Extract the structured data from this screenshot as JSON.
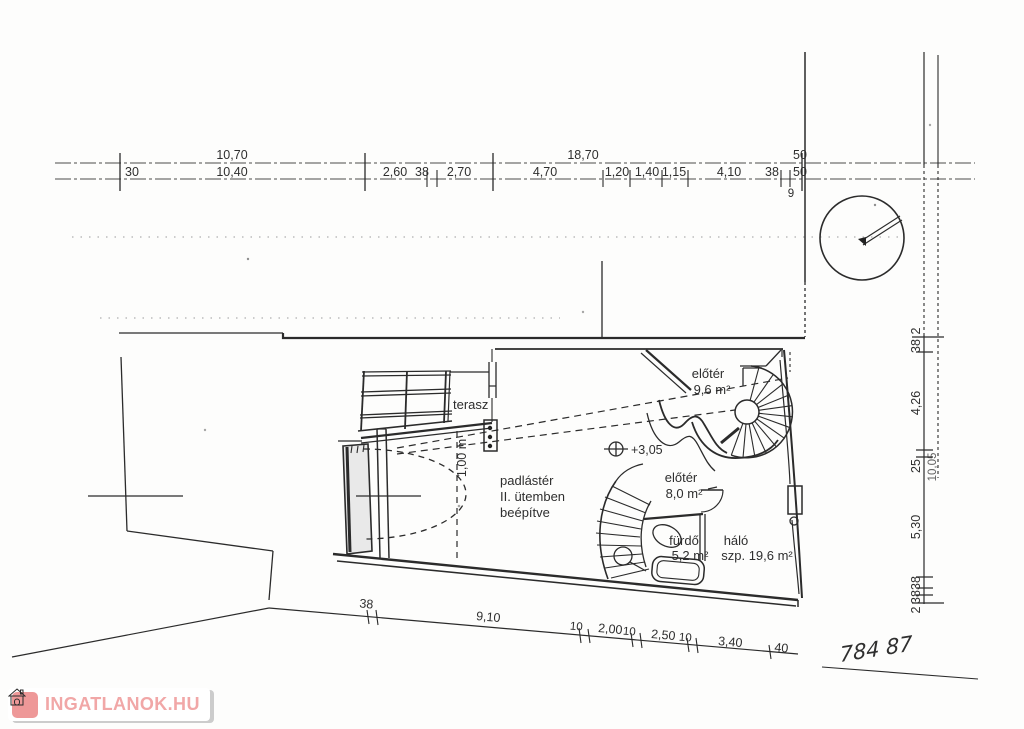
{
  "dimensions": {
    "top_overall": [
      "10,70",
      "18,70",
      "50"
    ],
    "top_detail": [
      "30",
      "10,40",
      "2,60",
      "38",
      "2,70",
      "4,70",
      "1,20",
      "1,40",
      "1,15",
      "4,10",
      "38",
      "50"
    ],
    "top_sub": "9",
    "right_detail": [
      "2",
      "38",
      "4,26",
      "25",
      "5,30",
      "38",
      "38",
      "2"
    ],
    "right_overall": "10,05",
    "bottom_detail": [
      "38",
      "9,10",
      "10",
      "2,00",
      "10",
      "2,50",
      "10",
      "3,40",
      "40"
    ]
  },
  "rooms": {
    "terasz": "terasz",
    "eloter_upper": "előtér",
    "eloter_upper_area": "9,6 m²",
    "padlaster_1": "padlástér",
    "padlaster_2": "II. ütemben",
    "padlaster_3": "beépítve",
    "eloter_lower": "előtér",
    "eloter_lower_area": "8,0 m²",
    "furdo": "fürdő",
    "furdo_area": "5,2 m²",
    "halo": "háló",
    "halo_area": "szp. 19,6 m²"
  },
  "marks": {
    "level": "+3,05",
    "height_clearance": "1,00 m",
    "handwritten": "784 87"
  },
  "watermark": {
    "text": "INGATLANOK.HU"
  },
  "colors": {
    "ink": "#2b2b2b",
    "watermark_pink": "#f1a7a7",
    "watermark_icon": "#ee9898",
    "shadow_gray": "#cccccc"
  }
}
